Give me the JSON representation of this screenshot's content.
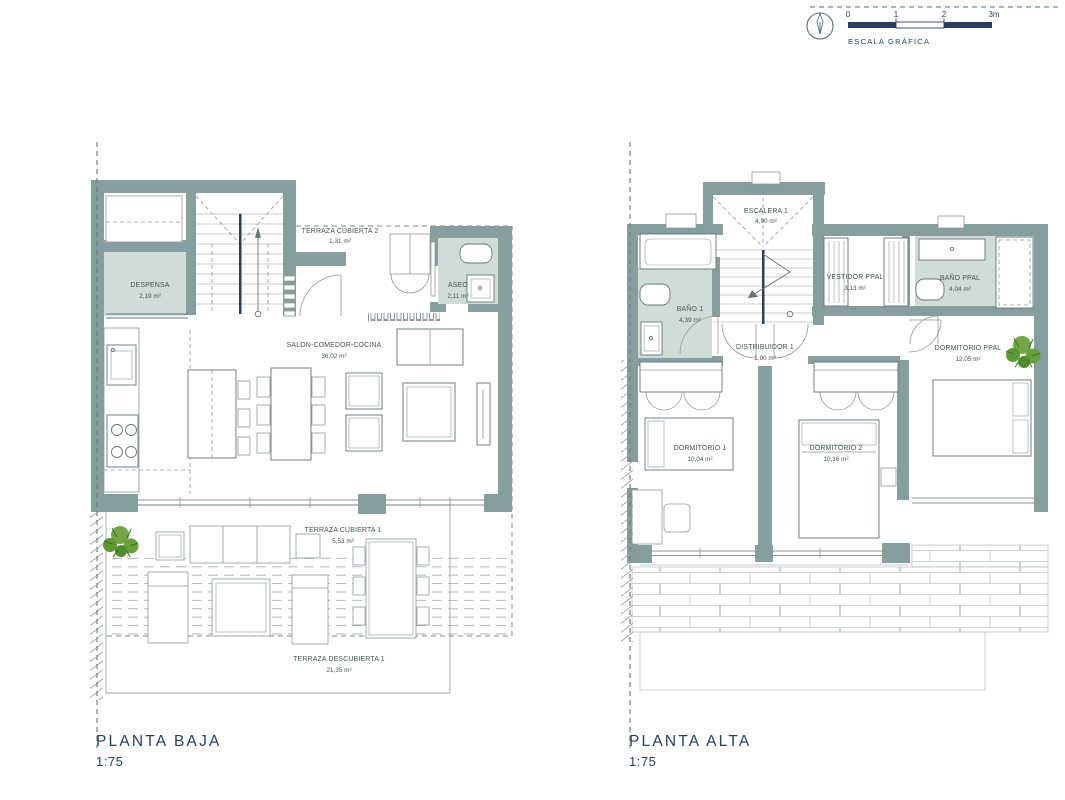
{
  "scale_bar": {
    "ticks": [
      "0",
      "1",
      "2",
      "3m"
    ],
    "caption": "ESCALA GRÁFICA"
  },
  "plans": [
    {
      "title": "PLANTA BAJA",
      "scale": "1:75",
      "rooms": [
        {
          "name": "TERRAZA CUBIERTA 2",
          "area": "1,31 m²"
        },
        {
          "name": "DESPENSA",
          "area": "2,19 m²"
        },
        {
          "name": "ASEO",
          "area": "2,11 m²"
        },
        {
          "name": "SALON-COMEDOR-COCINA",
          "area": "36,02 m²"
        },
        {
          "name": "TERRAZA CUBIERTA 1",
          "area": "5,53 m²"
        },
        {
          "name": "TERRAZA DESCUBIERTA 1",
          "area": "21,35 m²"
        }
      ]
    },
    {
      "title": "PLANTA ALTA",
      "scale": "1:75",
      "rooms": [
        {
          "name": "ESCALERA 1",
          "area": "4,90 m²"
        },
        {
          "name": "BAÑO 1",
          "area": "4,39 m²"
        },
        {
          "name": "VESTIDOR PPAL",
          "area": "3,13 m²"
        },
        {
          "name": "BAÑO PPAL",
          "area": "4,04 m²"
        },
        {
          "name": "DISTRIBUIDOR 1",
          "area": "1,90 m²"
        },
        {
          "name": "DORMITORIO PPAL",
          "area": "12,05 m²"
        },
        {
          "name": "DORMITORIO 1",
          "area": "10,04 m²"
        },
        {
          "name": "DORMITORIO 2",
          "area": "10,16 m²"
        }
      ]
    }
  ],
  "colors": {
    "wall": "#869e9d",
    "wet_room_fill": "#d0dcd8",
    "navy": "#24425f",
    "label_text": "#43534f",
    "line_gray": "#8d999e",
    "plant_green": "#67a03b"
  }
}
